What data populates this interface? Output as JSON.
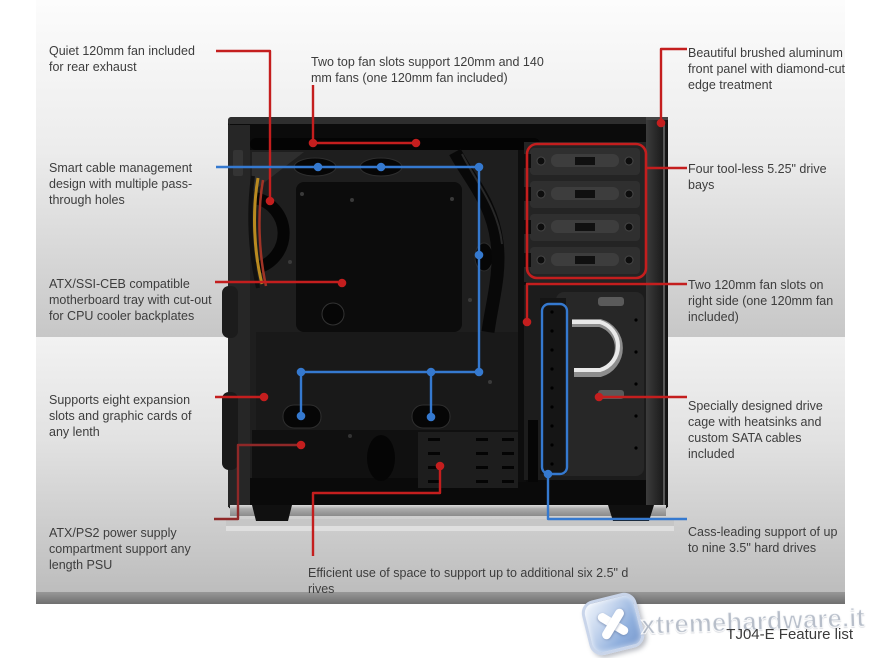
{
  "colors": {
    "accent_red": "#c41e1e",
    "accent_dark_red": "#8f2828",
    "accent_blue": "#3579cf",
    "text": "#3d3d3d"
  },
  "callouts": {
    "quiet_fan": "Quiet 120mm fan included\nfor rear exhaust",
    "cable_management": "Smart cable management\ndesign with multiple pass-\nthrough holes",
    "motherboard_tray": "ATX/SSI-CEB compatible\nmotherboard tray with cut-out\nfor CPU cooler backplates",
    "expansion_slots": "Supports eight expansion\nslots and graphic cards of\nany lenth",
    "psu_compartment": "ATX/PS2 power supply\ncompartment support any\nlength PSU",
    "top_fan_slots": "Two top fan slots support 120mm and 140\nmm fans (one 120mm fan included)",
    "ssd_support": "Efficient use of space to support up to additional six 2.5\" d\nrives",
    "front_panel": "Beautiful brushed aluminum\nfront panel with diamond-cut\nedge treatment",
    "drive_bays": "Four tool-less 5.25\" drive\nbays",
    "side_fan_slots": "Two 120mm fan slots on\nright side (one 120mm fan\nincluded)",
    "drive_cage": "Specially designed drive\ncage with heatsinks and\ncustom SATA cables\nincluded",
    "hdd_support": "Cass-leading support of up\nto nine 3.5\" hard drives"
  },
  "footer": {
    "caption": "TJ04-E Feature list"
  },
  "watermark": {
    "site": "xtremehardware.it"
  }
}
